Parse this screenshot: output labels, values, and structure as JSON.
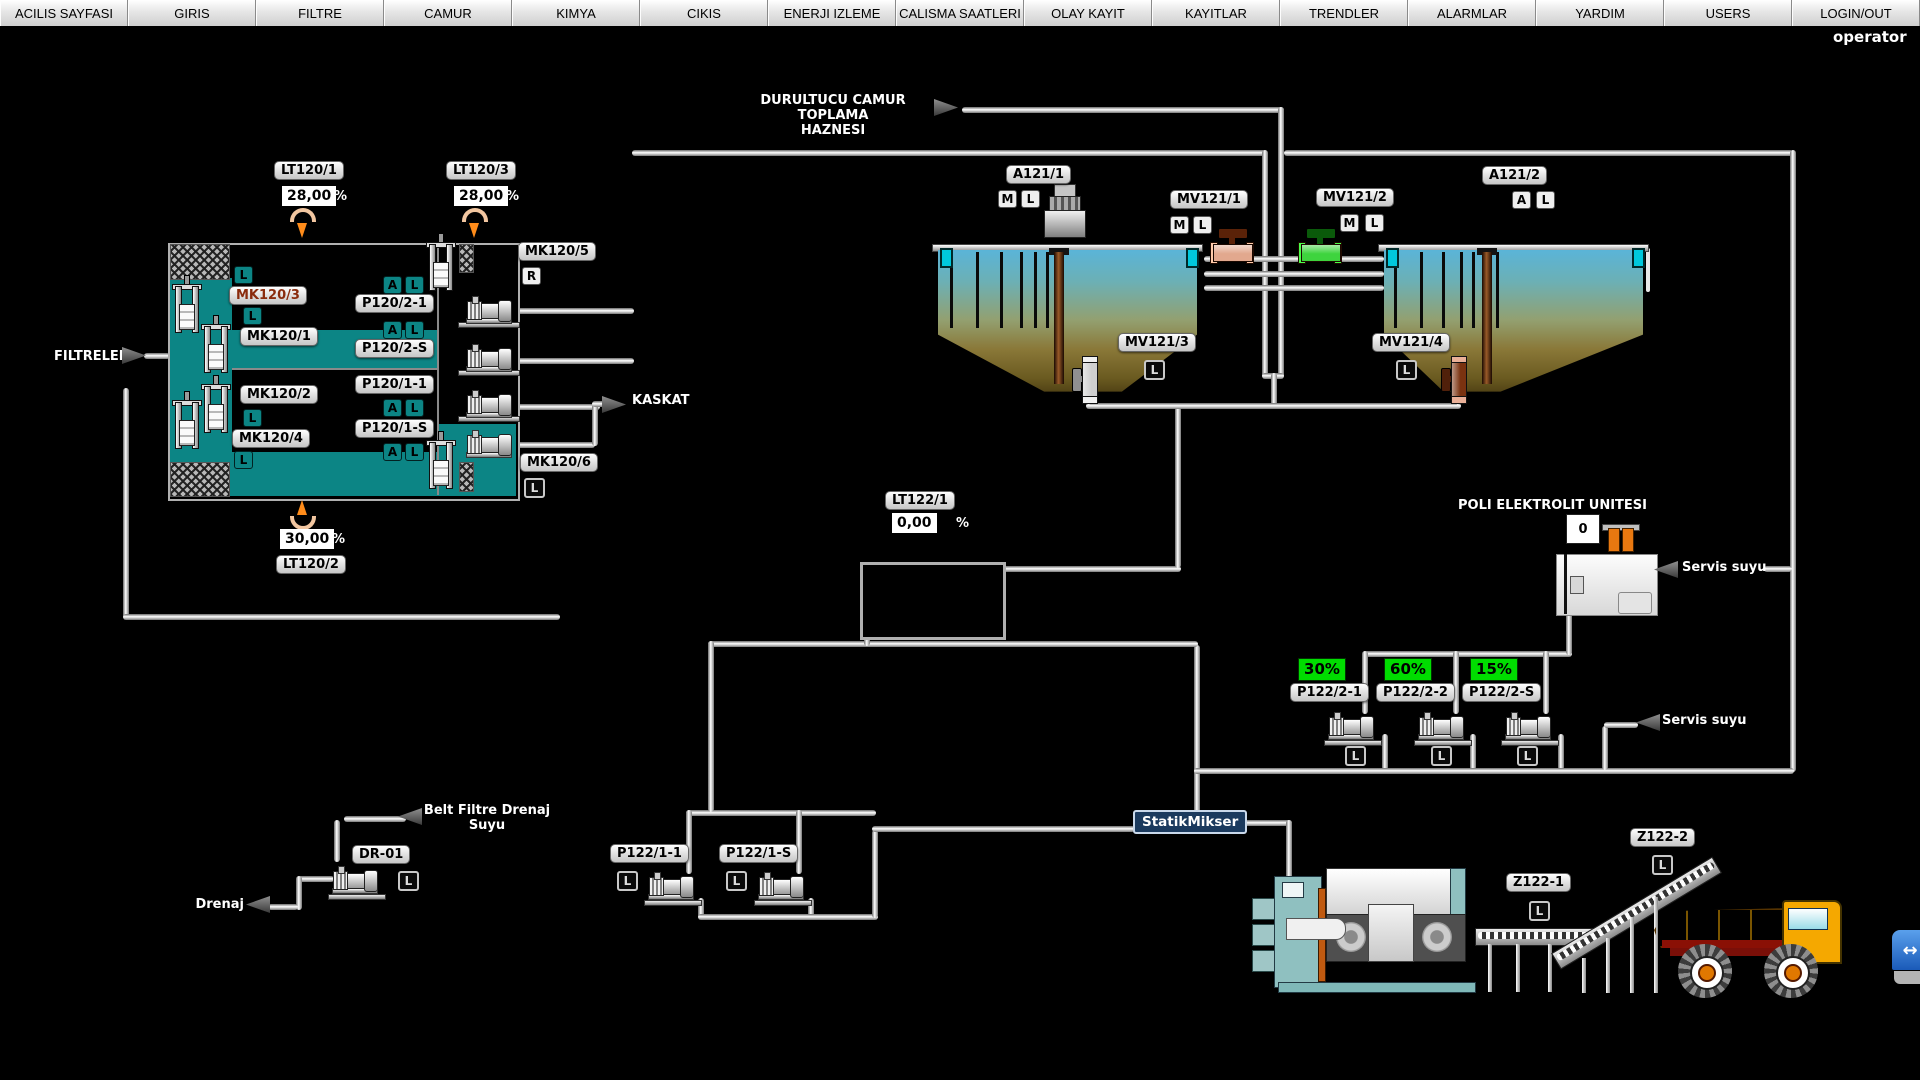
{
  "user_label": "operator",
  "menu": {
    "items": [
      "ACILIS SAYFASI",
      "GIRIS",
      "FILTRE",
      "CAMUR",
      "KIMYA",
      "CIKIS",
      "ENERJI IZLEME",
      "CALISMA SAATLERI",
      "OLAY KAYIT",
      "KAYITLAR",
      "TRENDLER",
      "ALARMLAR",
      "YARDIM",
      "USERS",
      "LOGIN/OUT"
    ]
  },
  "letters": {
    "A": "A",
    "L": "L",
    "M": "M",
    "R": "R"
  },
  "flow": {
    "filtreler": "FILTRELER",
    "kaskat": "KASKAT",
    "durultucu_1": "DURULTUCU CAMUR TOPLAMA",
    "durultucu_2": "HAZNESI",
    "servis_suyu_1": "Servis suyu",
    "servis_suyu_2": "Servis suyu",
    "belt_1": "Belt Filtre Drenaj",
    "belt_2": "Suyu",
    "drenaj": "Drenaj",
    "poli_title": "POLI ELEKTROLIT UNITESI"
  },
  "filters": {
    "lt120_1": {
      "label": "LT120/1",
      "value": "28,00",
      "unit": "%"
    },
    "lt120_3": {
      "label": "LT120/3",
      "value": "28,00",
      "unit": "%"
    },
    "lt120_2": {
      "label": "LT120/2",
      "value": "30,00",
      "unit": "%"
    },
    "mk120_3": "MK120/3",
    "mk120_1": "MK120/1",
    "mk120_2": "MK120/2",
    "mk120_4": "MK120/4",
    "mk120_5": "MK120/5",
    "mk120_6": "MK120/6",
    "p120_2_1": "P120/2-1",
    "p120_2_s": "P120/2-S",
    "p120_1_1": "P120/1-1",
    "p120_1_s": "P120/1-S"
  },
  "clarifiers": {
    "a121_1": "A121/1",
    "a121_2": "A121/2",
    "mv121_1": "MV121/1",
    "mv121_2": "MV121/2",
    "mv121_3": "MV121/3",
    "mv121_4": "MV121/4"
  },
  "sludge": {
    "lt122_1": {
      "label": "LT122/1",
      "value": "0,00",
      "unit": "%"
    },
    "poly_level": "0",
    "p122_2_1": {
      "label": "P122/2-1",
      "value": "30%"
    },
    "p122_2_2": {
      "label": "P122/2-2",
      "value": "60%"
    },
    "p122_2_s": {
      "label": "P122/2-S",
      "value": "15%"
    },
    "p122_1_1": "P122/1-1",
    "p122_1_s": "P122/1-S",
    "statik_mikser": "StatikMikser",
    "z122_1": "Z122-1",
    "z122_2": "Z122-2",
    "dr_01": "DR-01"
  },
  "colors": {
    "teal": "#0c8585",
    "status_green": "#00dd00",
    "statik_bg": "#1b3a5e",
    "valve_1": "#e2a88e",
    "valve_2": "#3ed43e",
    "valve_3": "#cfcfcf",
    "valve_4": "#7a3210"
  }
}
